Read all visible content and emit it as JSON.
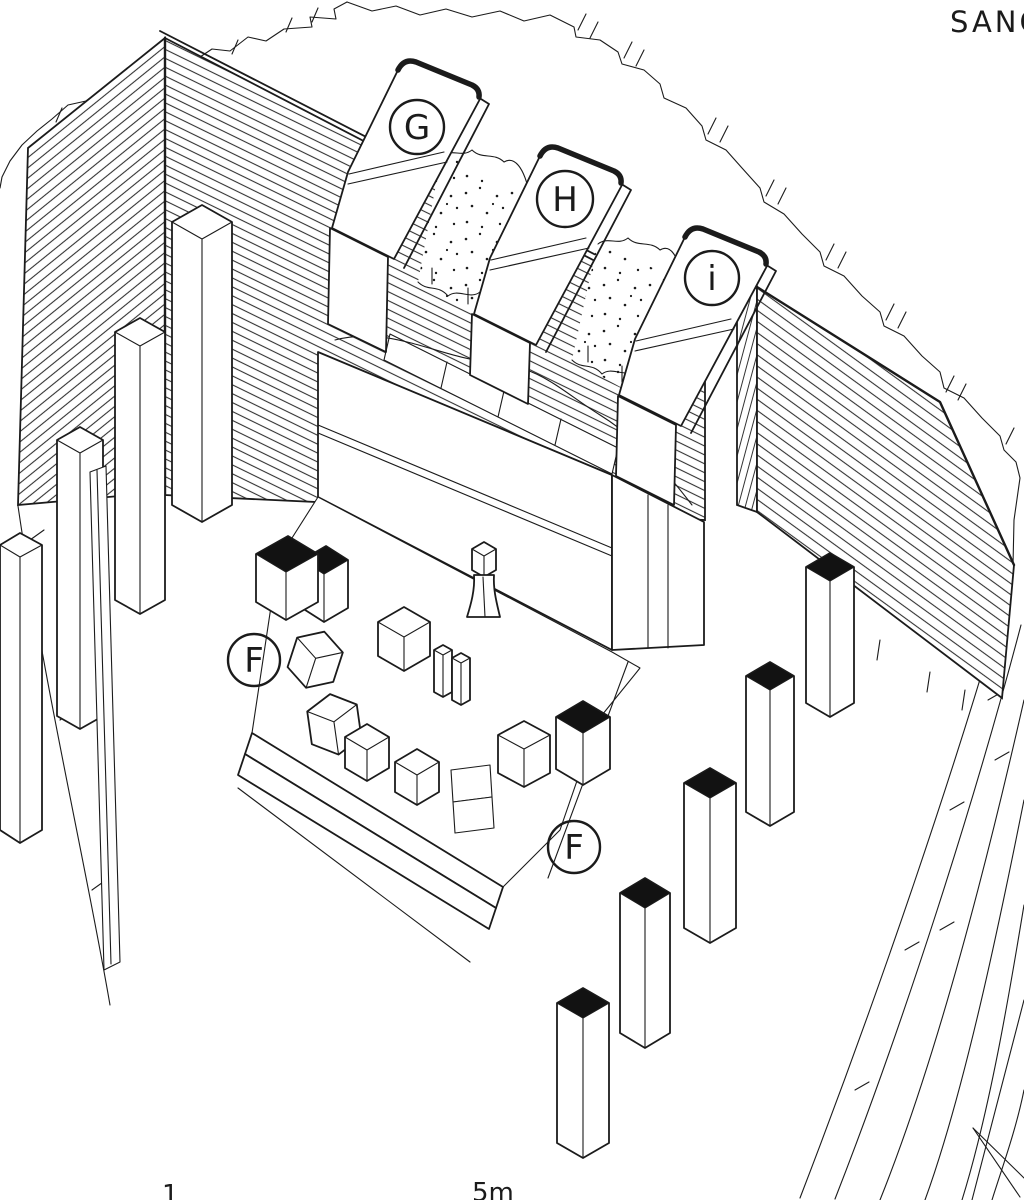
{
  "drawing": {
    "title": "SANC",
    "stela_labels": {
      "g": "G",
      "h": "H",
      "i": "i"
    },
    "floor_labels": {
      "f1": "F",
      "f2": "F"
    },
    "scale": {
      "start": "1",
      "end": "5m"
    },
    "colors": {
      "ink": "#1b1b1b",
      "paper": "#ffffff",
      "solid_black": "#121212"
    }
  }
}
